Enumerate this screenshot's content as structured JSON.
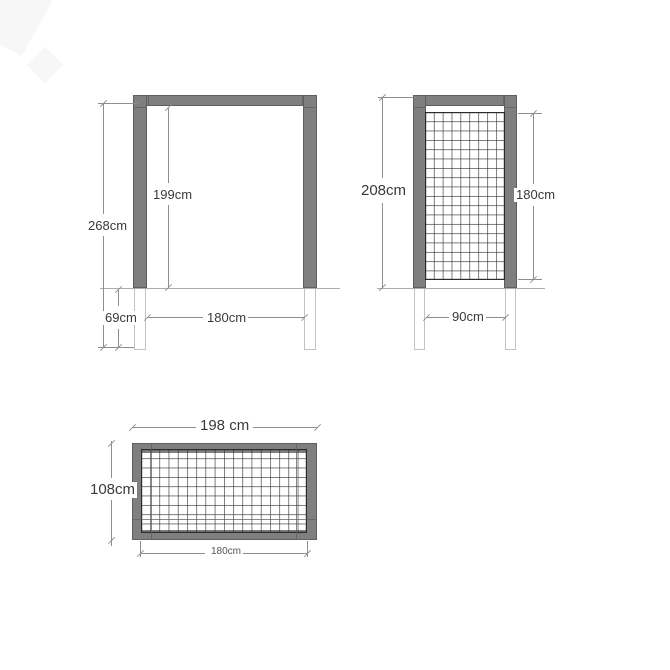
{
  "front_view": {
    "height_total": "268cm",
    "height_inner": "199cm",
    "post_underground": "69cm",
    "width_inner": "180cm"
  },
  "side_view": {
    "height_total": "208cm",
    "trellis_height": "180cm",
    "width_inner": "90cm"
  },
  "top_view": {
    "width_total": "198 cm",
    "depth_total": "108cm",
    "width_inner": "180cm"
  },
  "colors": {
    "frame_fill": "#7f7f7f",
    "frame_edge": "#5f5f5f",
    "grid_line": "#2b2b2b",
    "dim_line": "#8e8e8e",
    "text": "#3a3a3a",
    "ground_line": "#ababab",
    "underground_edge": "#c2c2c2"
  }
}
